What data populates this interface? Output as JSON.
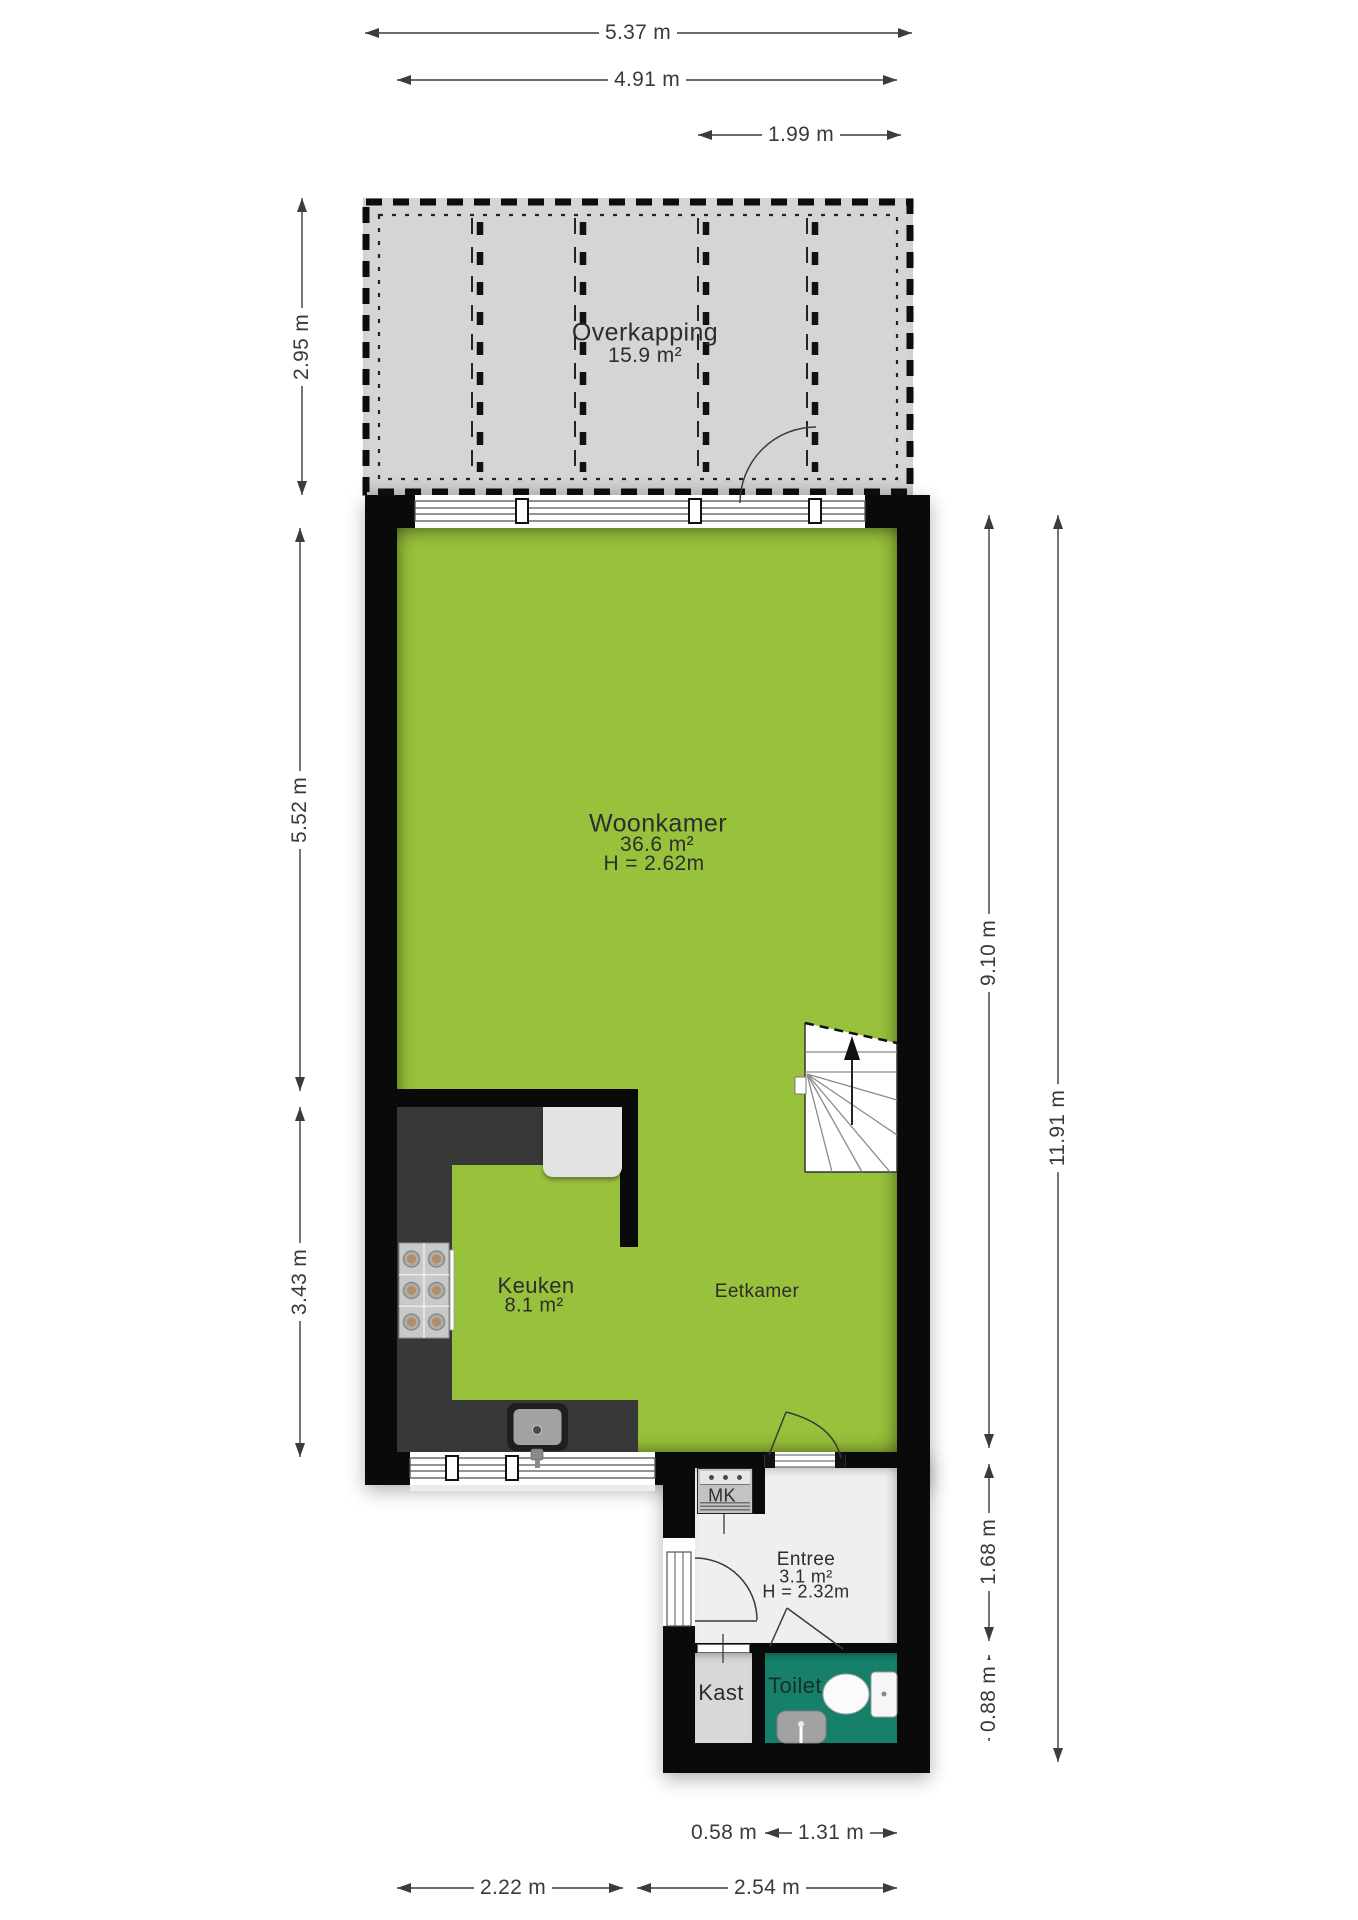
{
  "title": "Begane grond plattegrond",
  "colors": {
    "floor_green": "#99c23c",
    "overkapping_gray": "#d5d5d5",
    "wall_black": "#0a0a0a",
    "counter_dark": "#383838",
    "toilet_teal": "#16806a",
    "entree_floor": "#efefef",
    "kast_floor": "#d8d8d8",
    "dim_text": "#3a3a3a",
    "label_text": "#2d2d2d"
  },
  "rooms": {
    "overkapping": {
      "name": "Overkapping",
      "area": "15.9 m²"
    },
    "woonkamer": {
      "name": "Woonkamer",
      "area": "36.6 m²",
      "ceiling": "H = 2.62m"
    },
    "keuken": {
      "name": "Keuken",
      "area": "8.1 m²"
    },
    "eetkamer": {
      "name": "Eetkamer"
    },
    "entree": {
      "name": "Entree",
      "area": "3.1 m²",
      "ceiling": "H = 2.32m"
    },
    "mk": {
      "name": "MK"
    },
    "kast": {
      "name": "Kast"
    },
    "toilet": {
      "name": "Toilet"
    }
  },
  "dimensions": {
    "top_total": "5.37 m",
    "top_inner": "4.91 m",
    "top_door": "1.99 m",
    "left_overkapping": "2.95 m",
    "left_woonkamer": "5.52 m",
    "left_keuken": "3.43 m",
    "right_main": "9.10 m",
    "right_total": "11.91 m",
    "right_entree": "1.68 m",
    "right_toilet": "0.88 m",
    "bottom_kast": "0.58 m",
    "bottom_toilet": "1.31 m",
    "bottom_left": "2.22 m",
    "bottom_right": "2.54 m"
  }
}
